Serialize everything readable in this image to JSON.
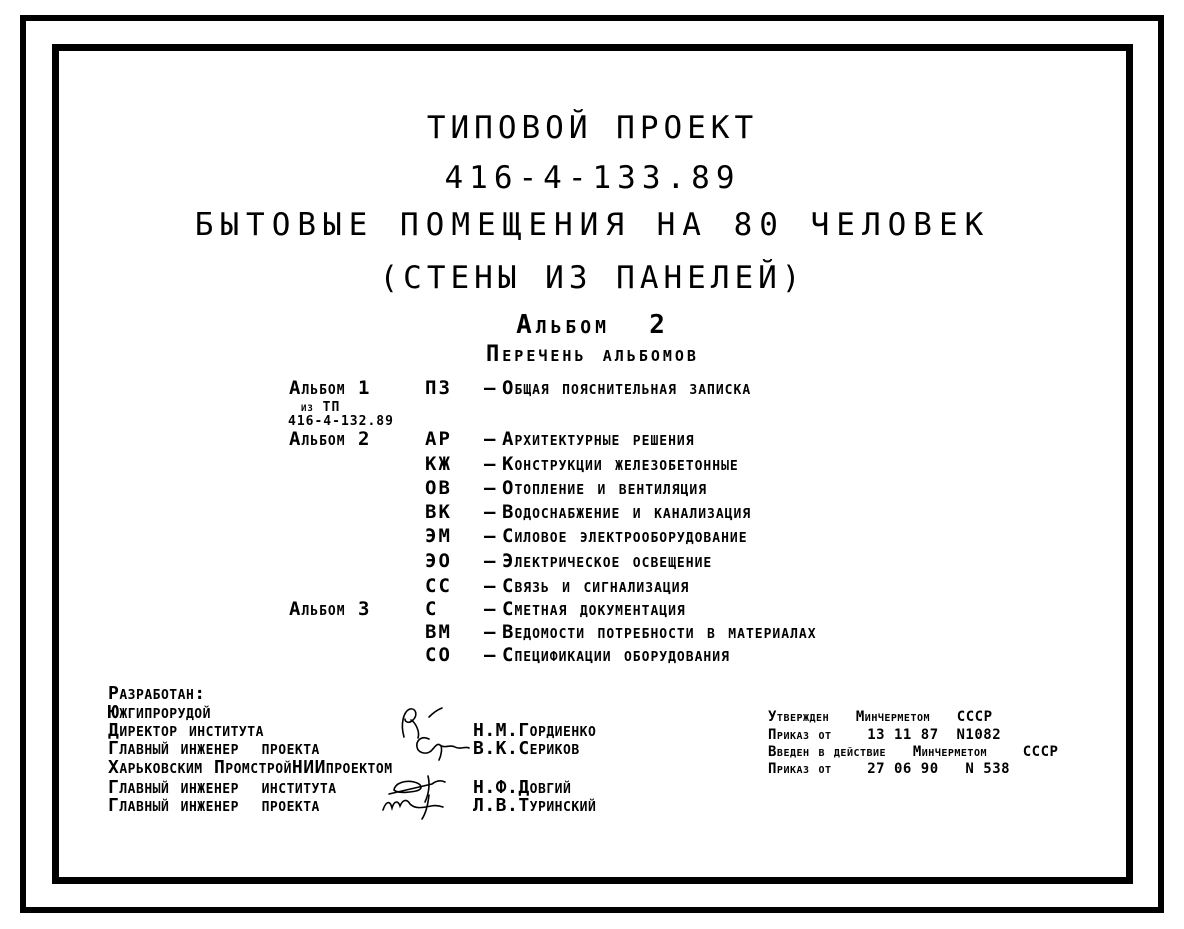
{
  "colors": {
    "ink": "#000000",
    "paper": "#ffffff"
  },
  "titles": {
    "line1": "ТИПОВОЙ ПРОЕКТ",
    "line2": "416-4-133.89",
    "line3": "БЫТОВЫЕ ПОМЕЩЕНИЯ НА 80 ЧЕЛОВЕК",
    "line4": "(СТЕНЫ ИЗ ПАНЕЛЕЙ)",
    "album_no": "Альбом  2",
    "list_heading": "Перечень альбомов"
  },
  "albums": {
    "dash": "–",
    "note_line1": "из ТП",
    "note_line2": "416-4-132.89",
    "items": [
      {
        "album": "Альбом 1",
        "code": "ПЗ",
        "desc": "Общая пояснительная записка"
      },
      {
        "album": "Альбом 2",
        "code": "АР",
        "desc": "Архитектурные решения"
      },
      {
        "album": "",
        "code": "КЖ",
        "desc": "Конструкции железобетонные"
      },
      {
        "album": "",
        "code": "ОВ",
        "desc": "Отопление и вентиляция"
      },
      {
        "album": "",
        "code": "ВК",
        "desc": "Водоснабжение и канализация"
      },
      {
        "album": "",
        "code": "ЭМ",
        "desc": "Силовое электрооборудование"
      },
      {
        "album": "",
        "code": "ЭО",
        "desc": "Электрическое освещение"
      },
      {
        "album": "",
        "code": "СС",
        "desc": "Связь и сигнализация"
      },
      {
        "album": "Альбом 3",
        "code": "С",
        "desc": "Сметная документация"
      },
      {
        "album": "",
        "code": "ВМ",
        "desc": "Ведомости потребности в материалах"
      },
      {
        "album": "",
        "code": "СО",
        "desc": "Спецификации оборудования"
      }
    ]
  },
  "developed": {
    "heading": "Разработан:",
    "org1": "Южгипрорудой",
    "row1_label": "Директор института",
    "row1_name": "Н.М.Гордиенко",
    "row2_label": "Главный инженер  проекта",
    "row2_name": "В.К.Сериков",
    "org2": "Харьковским ПромстройНИИпроектом",
    "row3_label": "Главный инженер  института",
    "row3_name": "Н.Ф.Довгий",
    "row4_label": "Главный инженер  проекта",
    "row4_name": "Л.В.Туринский"
  },
  "approval": {
    "line1": "Утвержден   Минчерметом   СССР",
    "line2": "Приказ от    13 11 87  N1082",
    "line3": "Введен в действие   Минчерметом    СССР",
    "line4": "Приказ от    27 06 90   N 538"
  }
}
